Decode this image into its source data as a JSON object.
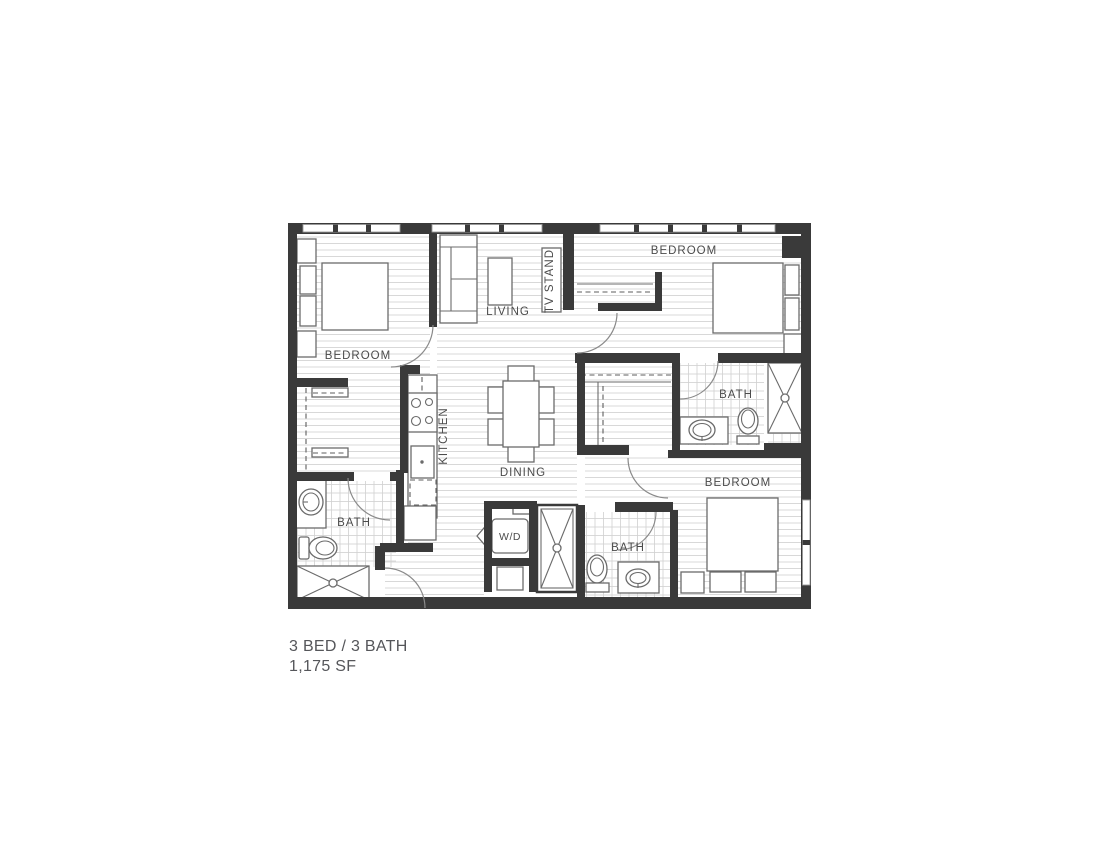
{
  "floor_plan": {
    "unit": {
      "beds_baths": "3 BED / 3 BATH",
      "area": "1,175 SF"
    },
    "labels": {
      "bedroom_top_left": "BEDROOM",
      "living": "LIVING",
      "tv_stand": "TV STAND",
      "bedroom_top_right": "BEDROOM",
      "bath_right": "BATH",
      "kitchen": "KITCHEN",
      "dining": "DINING",
      "bath_left": "BATH",
      "washer_dryer": "W/D",
      "bath_bottom": "BATH",
      "bedroom_bottom_right": "BEDROOM"
    },
    "colors": {
      "wall": "#3a3a3a",
      "furniture_line": "#6b6b6b",
      "floor_hatch": "#d8d8d8",
      "tile_line": "#d0d0d0",
      "label_text": "#4b4b4b",
      "caption_text": "#55565a",
      "background": "#ffffff"
    }
  }
}
